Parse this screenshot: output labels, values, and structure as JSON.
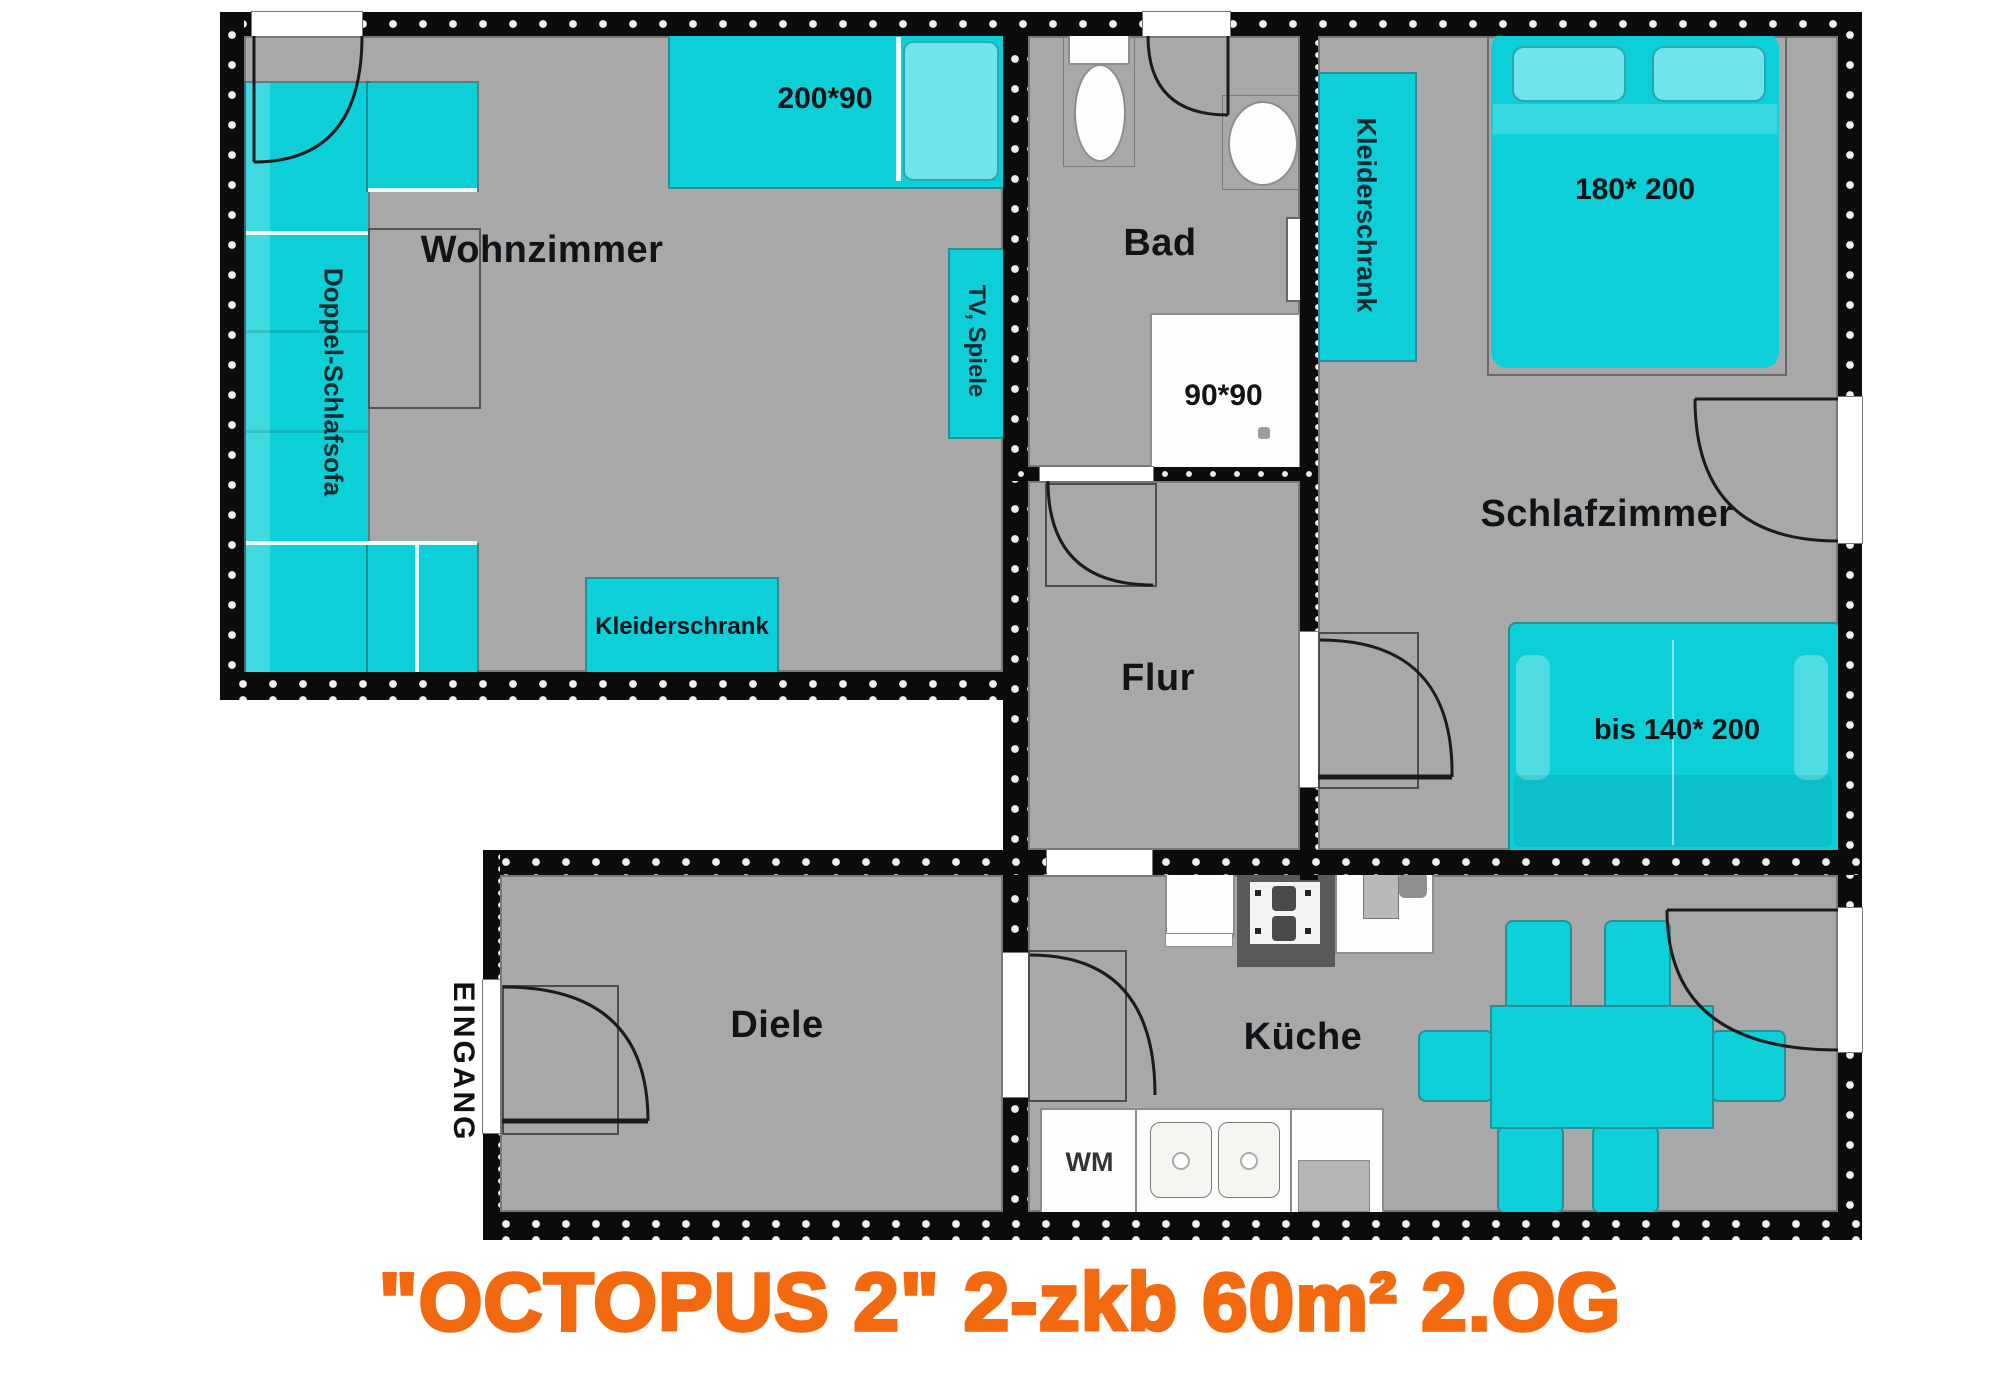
{
  "title": "\"OCTOPUS 2\"  2-zkb 60m² 2.OG",
  "colors": {
    "furniture_cyan": "#0ccfd8",
    "floor_gray": "#a8a8a8",
    "wall_black": "#0c0c0c",
    "title_orange": "#f2690f"
  },
  "rooms": {
    "wohnzimmer": {
      "label": "Wohnzimmer"
    },
    "bad": {
      "label": "Bad"
    },
    "flur": {
      "label": "Flur"
    },
    "schlafzimmer": {
      "label": "Schlafzimmer"
    },
    "kueche": {
      "label": "Küche"
    },
    "diele": {
      "label": "Diele"
    }
  },
  "furniture": {
    "doppel_schlafsofa": "Doppel-Schlafsofa",
    "bed_wohnzimmer": "200*90",
    "tv_spiele": "TV, Spiele",
    "kleiderschrank_wohnzimmer": "Kleiderschrank",
    "kleiderschrank_schlafzimmer": "Kleiderschrank",
    "bed_schlafzimmer": "180* 200",
    "schlafsofa_bedroom": "bis 140* 200",
    "shower": "90*90",
    "waschmaschine": "WM",
    "eingang": "EINGANG"
  }
}
